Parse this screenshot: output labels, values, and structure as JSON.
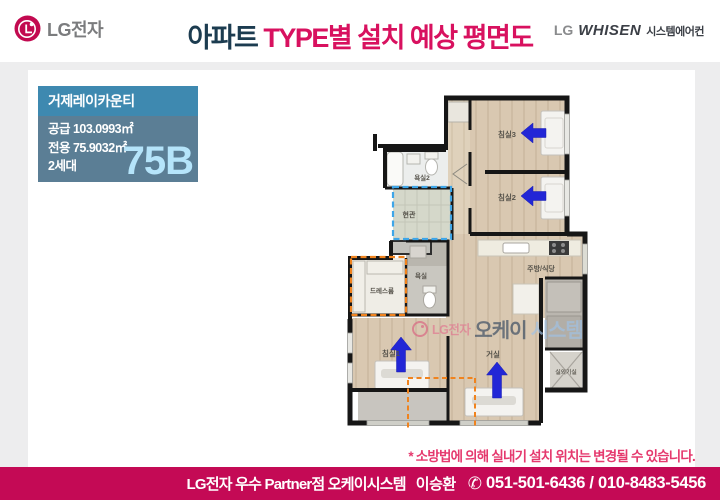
{
  "header": {
    "lg_text": "LG전자",
    "title_dark": "아파트 ",
    "title_accent": "TYPE별 설치 예상 평면도",
    "whisen_lg": "LG",
    "whisen_brand": "WHISEN",
    "whisen_suffix": "시스템에어컨"
  },
  "info_box": {
    "name": "거제레이카운티",
    "rows": [
      "공급 103.0993㎡",
      "전용 75.9032㎡",
      "2세대"
    ],
    "type_code": "75B"
  },
  "floor_plan": {
    "rooms": {
      "bedroom3": "침실3",
      "bedroom2": "침실2",
      "bath2": "욕실2",
      "entrance": "현관",
      "dressroom": "드레스룸",
      "bath": "욕실",
      "kitchen": "주방/식당",
      "living": "거실",
      "bedroom1": "침실1",
      "outdoor_unit": "실외기실"
    },
    "colors": {
      "wood": "#d9c8b1",
      "wall": "#161616",
      "arrow_blue": "#2226d6",
      "dash_blue": "#3ea6e8",
      "dash_orange": "#f0831e"
    }
  },
  "watermark": {
    "lg": "LG전자",
    "part1": "오케이",
    "part2": "시스템"
  },
  "note": {
    "text": "* 소방법에 의해 실내기 설치 위치는 변경될 수 있습니다."
  },
  "footer": {
    "dealer": "LG전자 우수 Partner점 오케이시스템",
    "name": "이승환",
    "phone_icon": "✆",
    "phone": "051-501-6436 / 010-8483-5456"
  }
}
